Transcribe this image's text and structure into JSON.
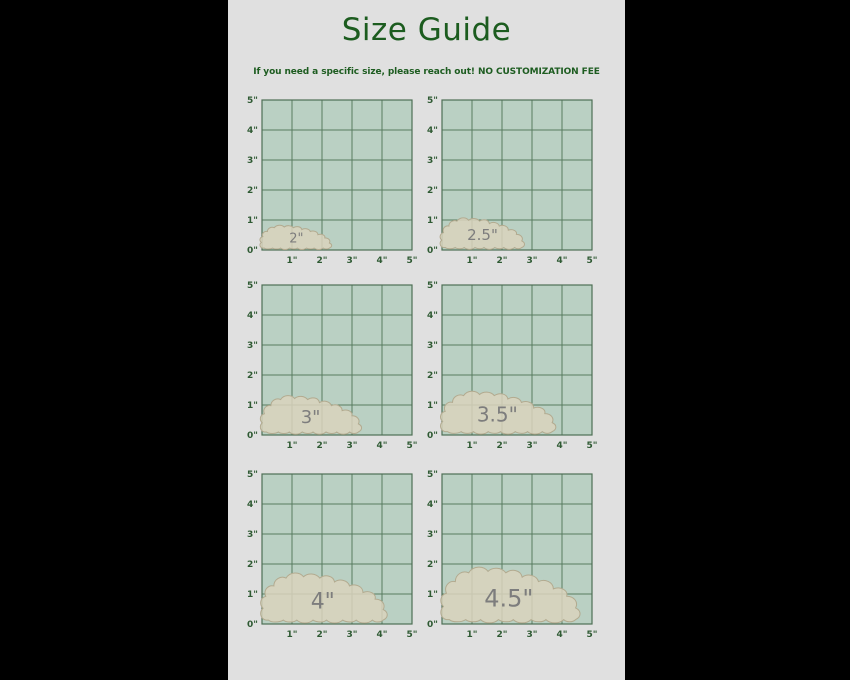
{
  "page": {
    "title": "Size Guide",
    "subtitle": "If you need a specific size, please reach out! NO CUSTOMIZATION FEE"
  },
  "colors": {
    "page_background": "#000000",
    "content_background": "#e0e0e0",
    "heading_green": "#1c5c1f",
    "grid_fill": "#bad0c3",
    "grid_line": "#587b5f",
    "grid_border": "#4e6f55",
    "tick_label": "#2f5a33",
    "blob_fill": "#d9d3bd",
    "blob_stroke": "#b2aa8f",
    "blob_label": "#7d7d7d"
  },
  "chart_data": {
    "type": "area",
    "title": "Size Guide",
    "subtitle": "If you need a specific size, please reach out! NO CUSTOMIZATION FEE",
    "layout_hint": "six 5in x 5in measurement grids, 2 columns x 3 rows, grid on, no legend",
    "axis": {
      "unit": "inches",
      "xlim": [
        0,
        5
      ],
      "ylim": [
        0,
        5
      ],
      "grid_step_in": 1,
      "x_ticks": [
        "1\"",
        "2\"",
        "3\"",
        "4\"",
        "5\""
      ],
      "y_ticks": [
        "5\"",
        "4\"",
        "3\"",
        "2\"",
        "1\"",
        "0\""
      ]
    },
    "panels": [
      {
        "label": "2\"",
        "size_inches": 2,
        "blob_width_in": 2.55,
        "blob_height_in": 0.85,
        "label_font_px": 13
      },
      {
        "label": "2.5\"",
        "size_inches": 2.5,
        "blob_width_in": 3.0,
        "blob_height_in": 1.1,
        "label_font_px": 15
      },
      {
        "label": "3\"",
        "size_inches": 3,
        "blob_width_in": 3.6,
        "blob_height_in": 1.35,
        "label_font_px": 18
      },
      {
        "label": "3.5\"",
        "size_inches": 3.5,
        "blob_width_in": 4.1,
        "blob_height_in": 1.5,
        "label_font_px": 20
      },
      {
        "label": "4\"",
        "size_inches": 4,
        "blob_width_in": 4.5,
        "blob_height_in": 1.75,
        "label_font_px": 22
      },
      {
        "label": "4.5\"",
        "size_inches": 4.5,
        "blob_width_in": 4.95,
        "blob_height_in": 1.95,
        "label_font_px": 24
      }
    ]
  }
}
